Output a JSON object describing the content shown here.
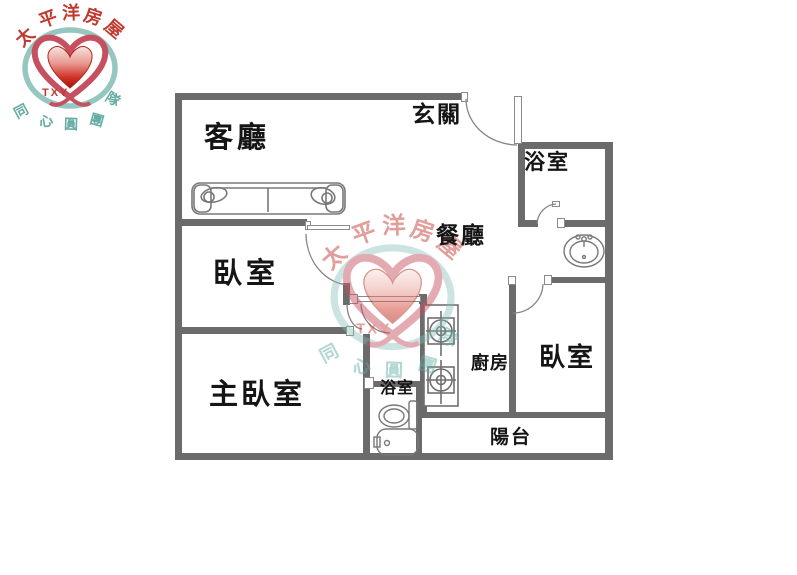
{
  "brand": {
    "name_chars": [
      "太",
      "平",
      "洋",
      "房",
      "屋"
    ],
    "code": "TXY",
    "motto_chars": [
      "同",
      "心",
      "圓",
      "團"
    ],
    "team_char": "隊",
    "colors": {
      "brand_red": "#c0392f",
      "brand_teal": "#7fbab3",
      "heart_red": "#cc2222",
      "wall_gray": "#6b6b6b"
    }
  },
  "rooms": {
    "living": "客廳",
    "entry": "玄關",
    "bath_top": "浴室",
    "dining": "餐廳",
    "bedroom_left": "臥室",
    "master": "主臥室",
    "kitchen": "廚房",
    "bedroom_right": "臥室",
    "bath_bottom": "浴室",
    "balcony": "陽台"
  },
  "fixtures": {
    "sofa": "sofa",
    "sink": "washbasin",
    "toilet": "toilet",
    "bathtub": "bathtub",
    "stove": "two-burner-stove"
  }
}
